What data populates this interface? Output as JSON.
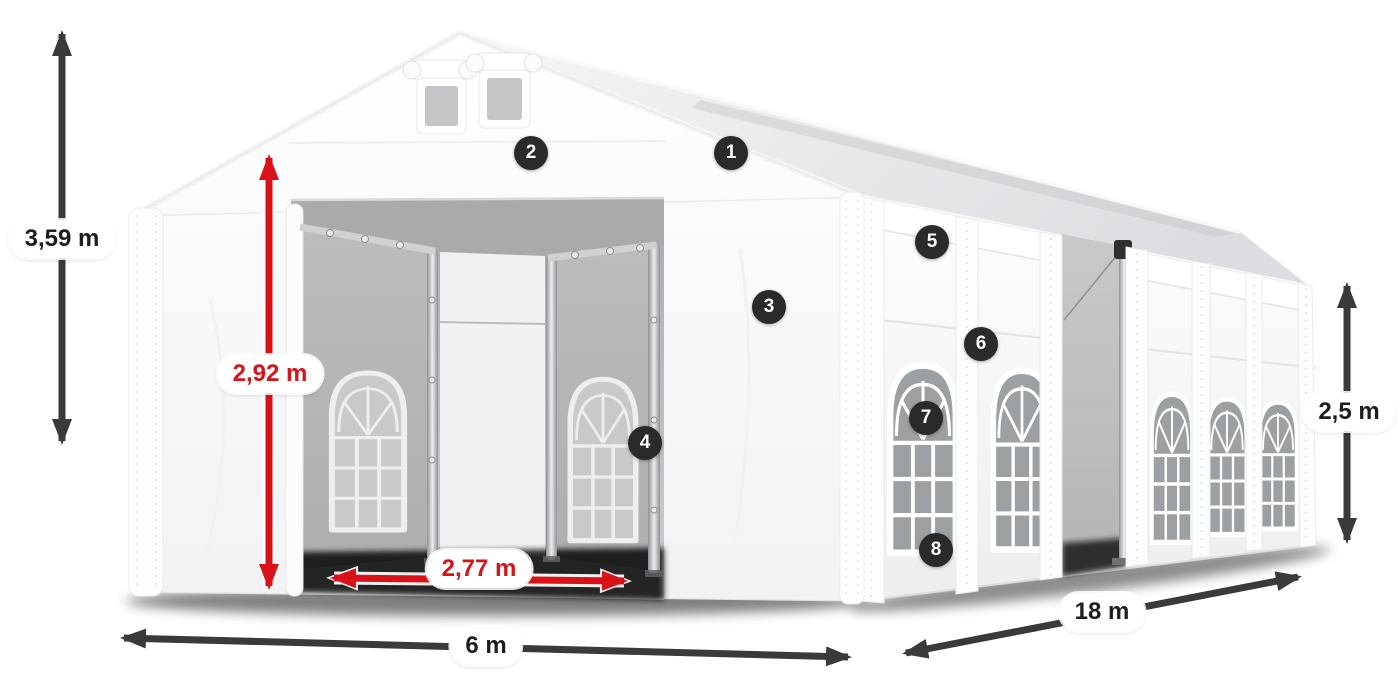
{
  "diagram": {
    "dimension_labels": {
      "total_height": "3,59 m",
      "entrance_height": "2,92 m",
      "entrance_width": "2,77 m",
      "front_width": "6 m",
      "side_length": "18 m",
      "wall_height": "2,5 m"
    },
    "callouts": [
      {
        "number": "1"
      },
      {
        "number": "2"
      },
      {
        "number": "3"
      },
      {
        "number": "4"
      },
      {
        "number": "5"
      },
      {
        "number": "6"
      },
      {
        "number": "7"
      },
      {
        "number": "8"
      }
    ],
    "colors": {
      "dimension_arrow": "#3a3a3a",
      "dimension_arrow_red": "#d9121a",
      "label_background": "#ffffff",
      "label_text": "#1d1d1d",
      "label_text_red": "#d9121a",
      "badge_background": "#2a2a2a",
      "badge_text": "#ffffff"
    }
  }
}
